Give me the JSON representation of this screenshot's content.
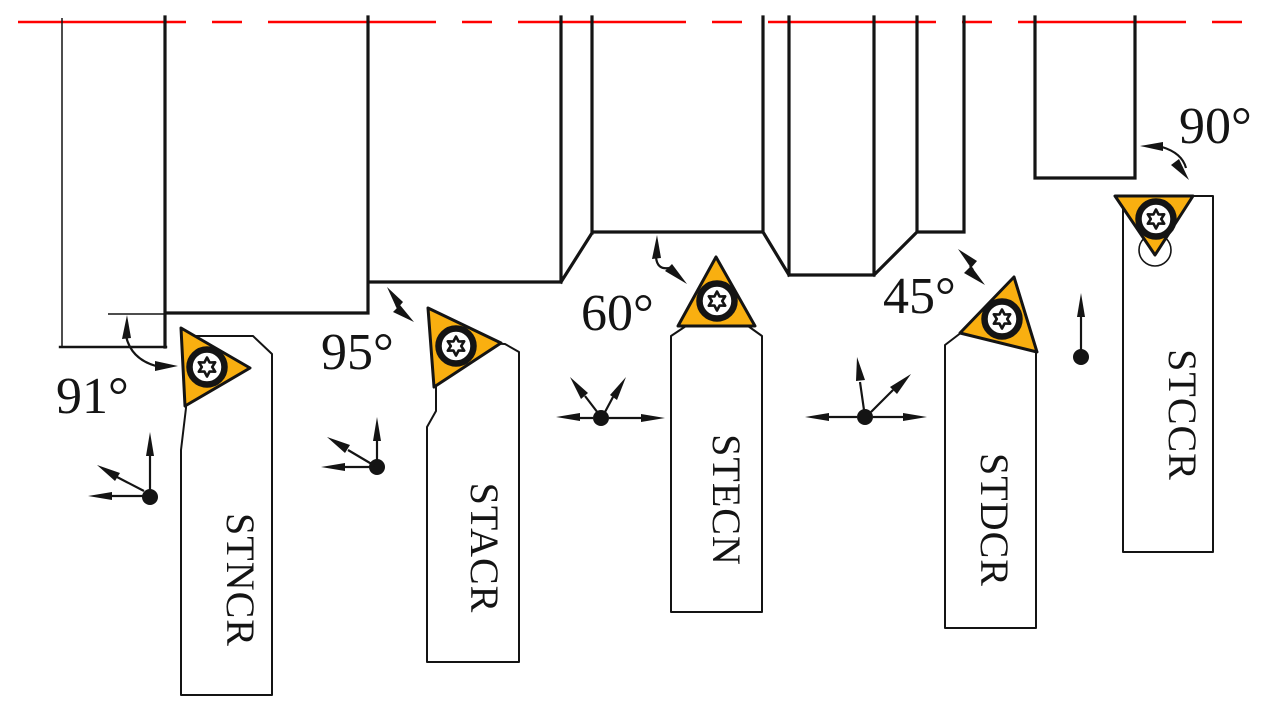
{
  "diagram": {
    "title_hint": "lathe-turning-toolholder-lead-angle-diagram",
    "tools": [
      {
        "name": "STNCR",
        "angle": "91°"
      },
      {
        "name": "STACR",
        "angle": "95°"
      },
      {
        "name": "STECN",
        "angle": "60°"
      },
      {
        "name": "STDCR",
        "angle": "45°"
      },
      {
        "name": "STCCR",
        "angle": "90°"
      }
    ],
    "colors": {
      "insert": "#F9AF10",
      "outline": "#141414",
      "holder": "#FFFFFF",
      "centerline": "#FF0000",
      "background": "#FFFFFF"
    }
  }
}
